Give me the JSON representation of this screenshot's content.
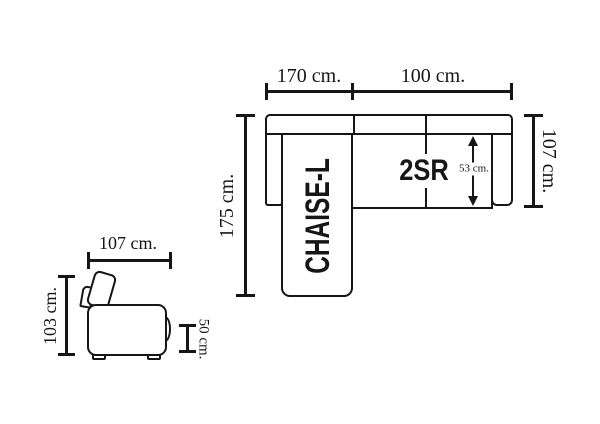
{
  "colors": {
    "line": "#161616",
    "background": "#ffffff"
  },
  "plan_view": {
    "chaise_label": "CHAISE-L",
    "seats_label": "2SR",
    "dim_chaise_width": "170 cm.",
    "dim_seats_width": "100 cm.",
    "dim_total_depth": "175 cm.",
    "dim_side_depth": "107 cm.",
    "dim_seat_depth": "53 cm."
  },
  "side_view": {
    "dim_width": "107 cm.",
    "dim_height": "103 cm.",
    "dim_seat_height": "50 cm."
  }
}
